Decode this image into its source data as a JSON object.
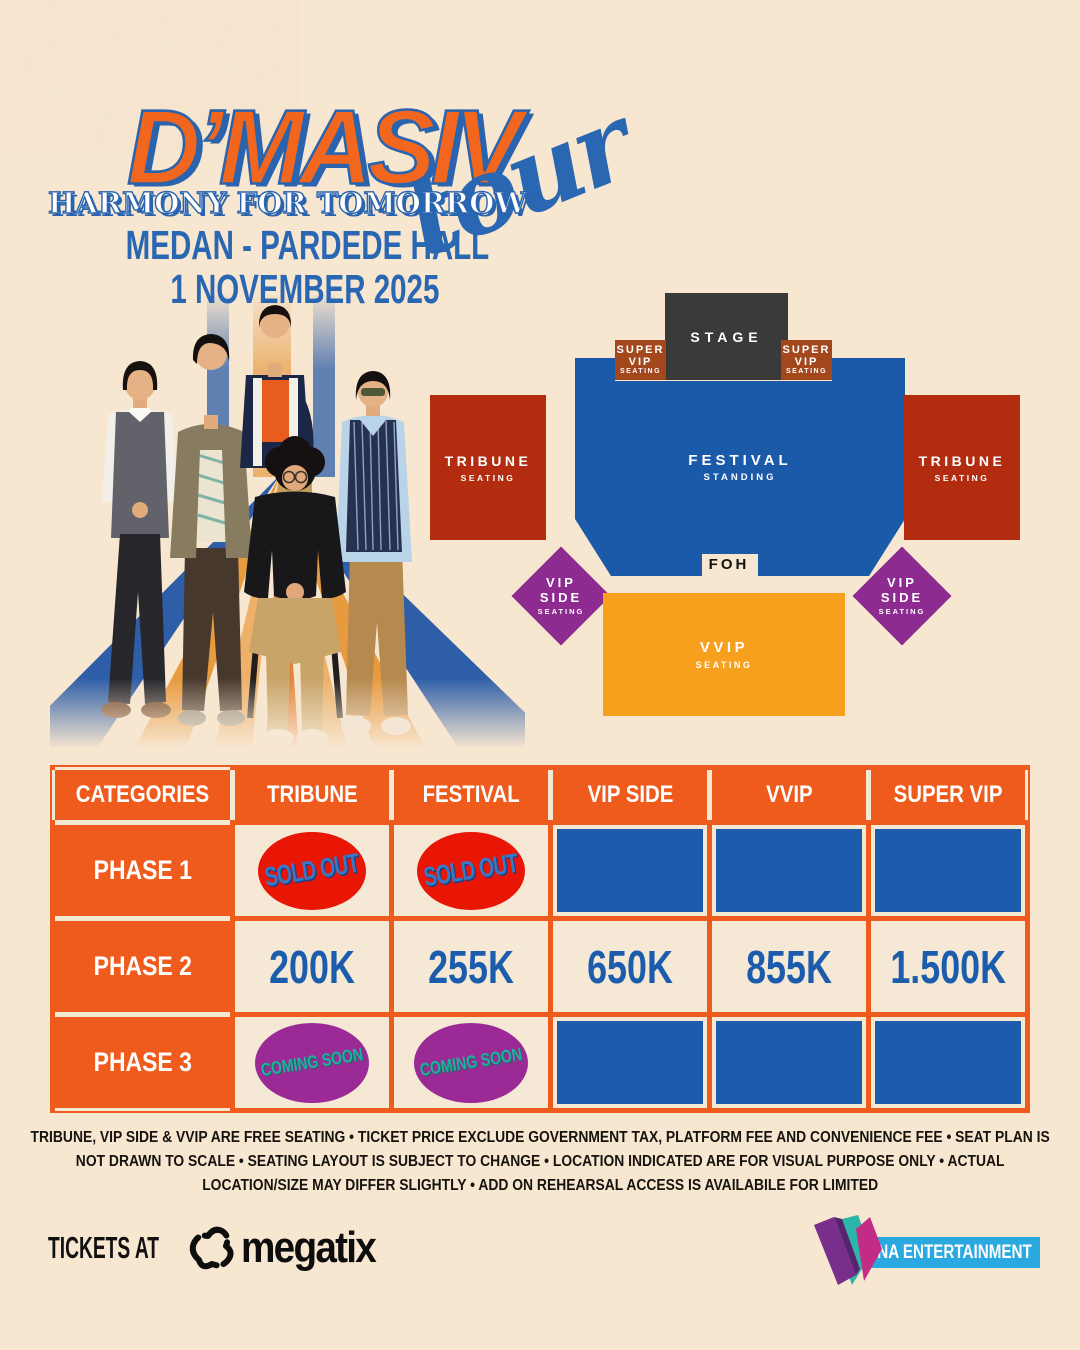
{
  "title": {
    "artist": "D’MASIV",
    "subtitle": "HARMONY FOR TOMORROW",
    "tour_script": "tour",
    "venue": "MEDAN - PARDEDE HALL",
    "date": "1 NOVEMBER 2025"
  },
  "seat_map": {
    "stage": "STAGE",
    "foh": "FOH",
    "super_vip": [
      "SUPER",
      "VIP",
      "SEATING"
    ],
    "tribune": [
      "TRIBUNE",
      "SEATING"
    ],
    "festival": [
      "FESTIVAL",
      "STANDING"
    ],
    "vip_side": [
      "VIP",
      "SIDE",
      "SEATING"
    ],
    "vvip": [
      "VVIP",
      "SEATING"
    ]
  },
  "pricing": {
    "headers": [
      "CATEGORIES",
      "TRIBUNE",
      "FESTIVAL",
      "VIP SIDE",
      "VVIP",
      "SUPER VIP"
    ],
    "row_labels": [
      "PHASE 1",
      "PHASE 2",
      "PHASE 3"
    ],
    "sold_out_label": "SOLD OUT",
    "coming_soon_label": "COMING SOON",
    "phase2": {
      "tribune": "200K",
      "festival": "255K",
      "vip_side": "650K",
      "vvip": "855K",
      "super_vip": "1.500K"
    }
  },
  "disclaimer": "TRIBUNE, VIP SIDE & VVIP ARE FREE SEATING  •  TICKET PRICE EXCLUDE GOVERNMENT TAX, PLATFORM FEE AND CONVENIENCE FEE  •  SEAT PLAN IS NOT DRAWN TO SCALE • SEATING LAYOUT IS SUBJECT TO CHANGE  •  LOCATION INDICATED ARE FOR VISUAL PURPOSE ONLY  •  ACTUAL  LOCATION/SIZE MAY DIFFER SLIGHTLY  •  ADD ON REHEARSAL ACCESS IS AVAILABILE FOR LIMITED",
  "footer": {
    "tickets_at": "TICKETS AT",
    "megatix": "megatix",
    "makna": "MAKNA ENTERTAINMENT"
  },
  "colors": {
    "background_cream": "#f7e6d0",
    "table_orange": "#ee5b1c",
    "title_orange": "#f3661d",
    "brand_blue": "#2a67b2",
    "table_blue": "#1c5cac",
    "tribune_red": "#b42c10",
    "super_vip_brown": "#a3481d",
    "vip_side_purple": "#8e2b90",
    "vvip_orange": "#f6a01e",
    "stage_gray": "#3a3a39",
    "sold_out_red": "#e91505",
    "coming_soon_purple": "#9c2a96",
    "makna_bar_cyan": "#29a9e0"
  }
}
